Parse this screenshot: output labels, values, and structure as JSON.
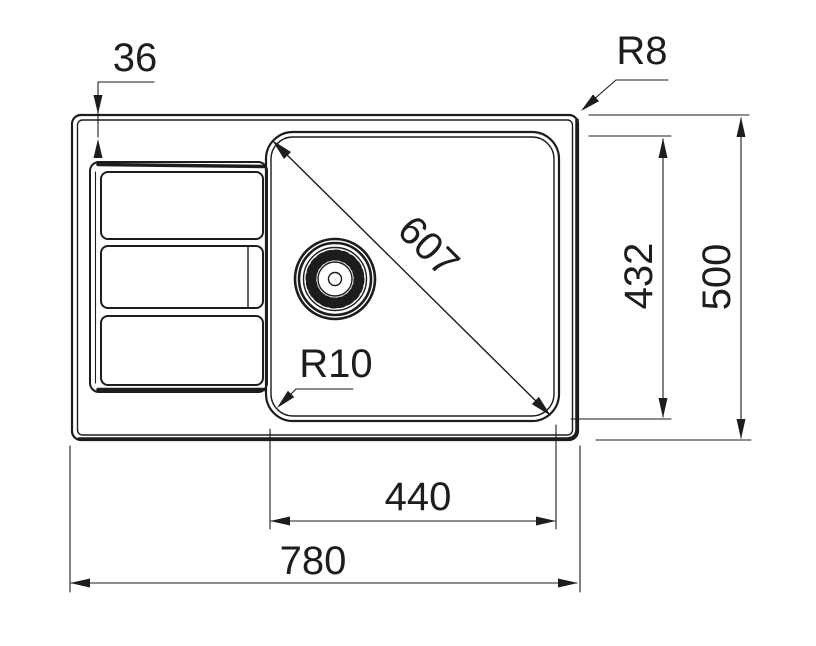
{
  "drawing": {
    "title": "Kitchen sink technical dimension drawing, top view",
    "units": "mm",
    "background_color": "#ffffff",
    "line_color": "#1d1d1b",
    "features": [
      "outer rim",
      "drainboard with three ribs",
      "main bowl",
      "basket strainer drain"
    ]
  },
  "labels": {
    "edge_offset": "36",
    "outer_corner_radius": "R8",
    "bowl_diagonal": "607",
    "bowl_corner_radius": "R10",
    "bowl_depth": "432",
    "overall_depth": "500",
    "bowl_width": "440",
    "overall_width": "780"
  }
}
